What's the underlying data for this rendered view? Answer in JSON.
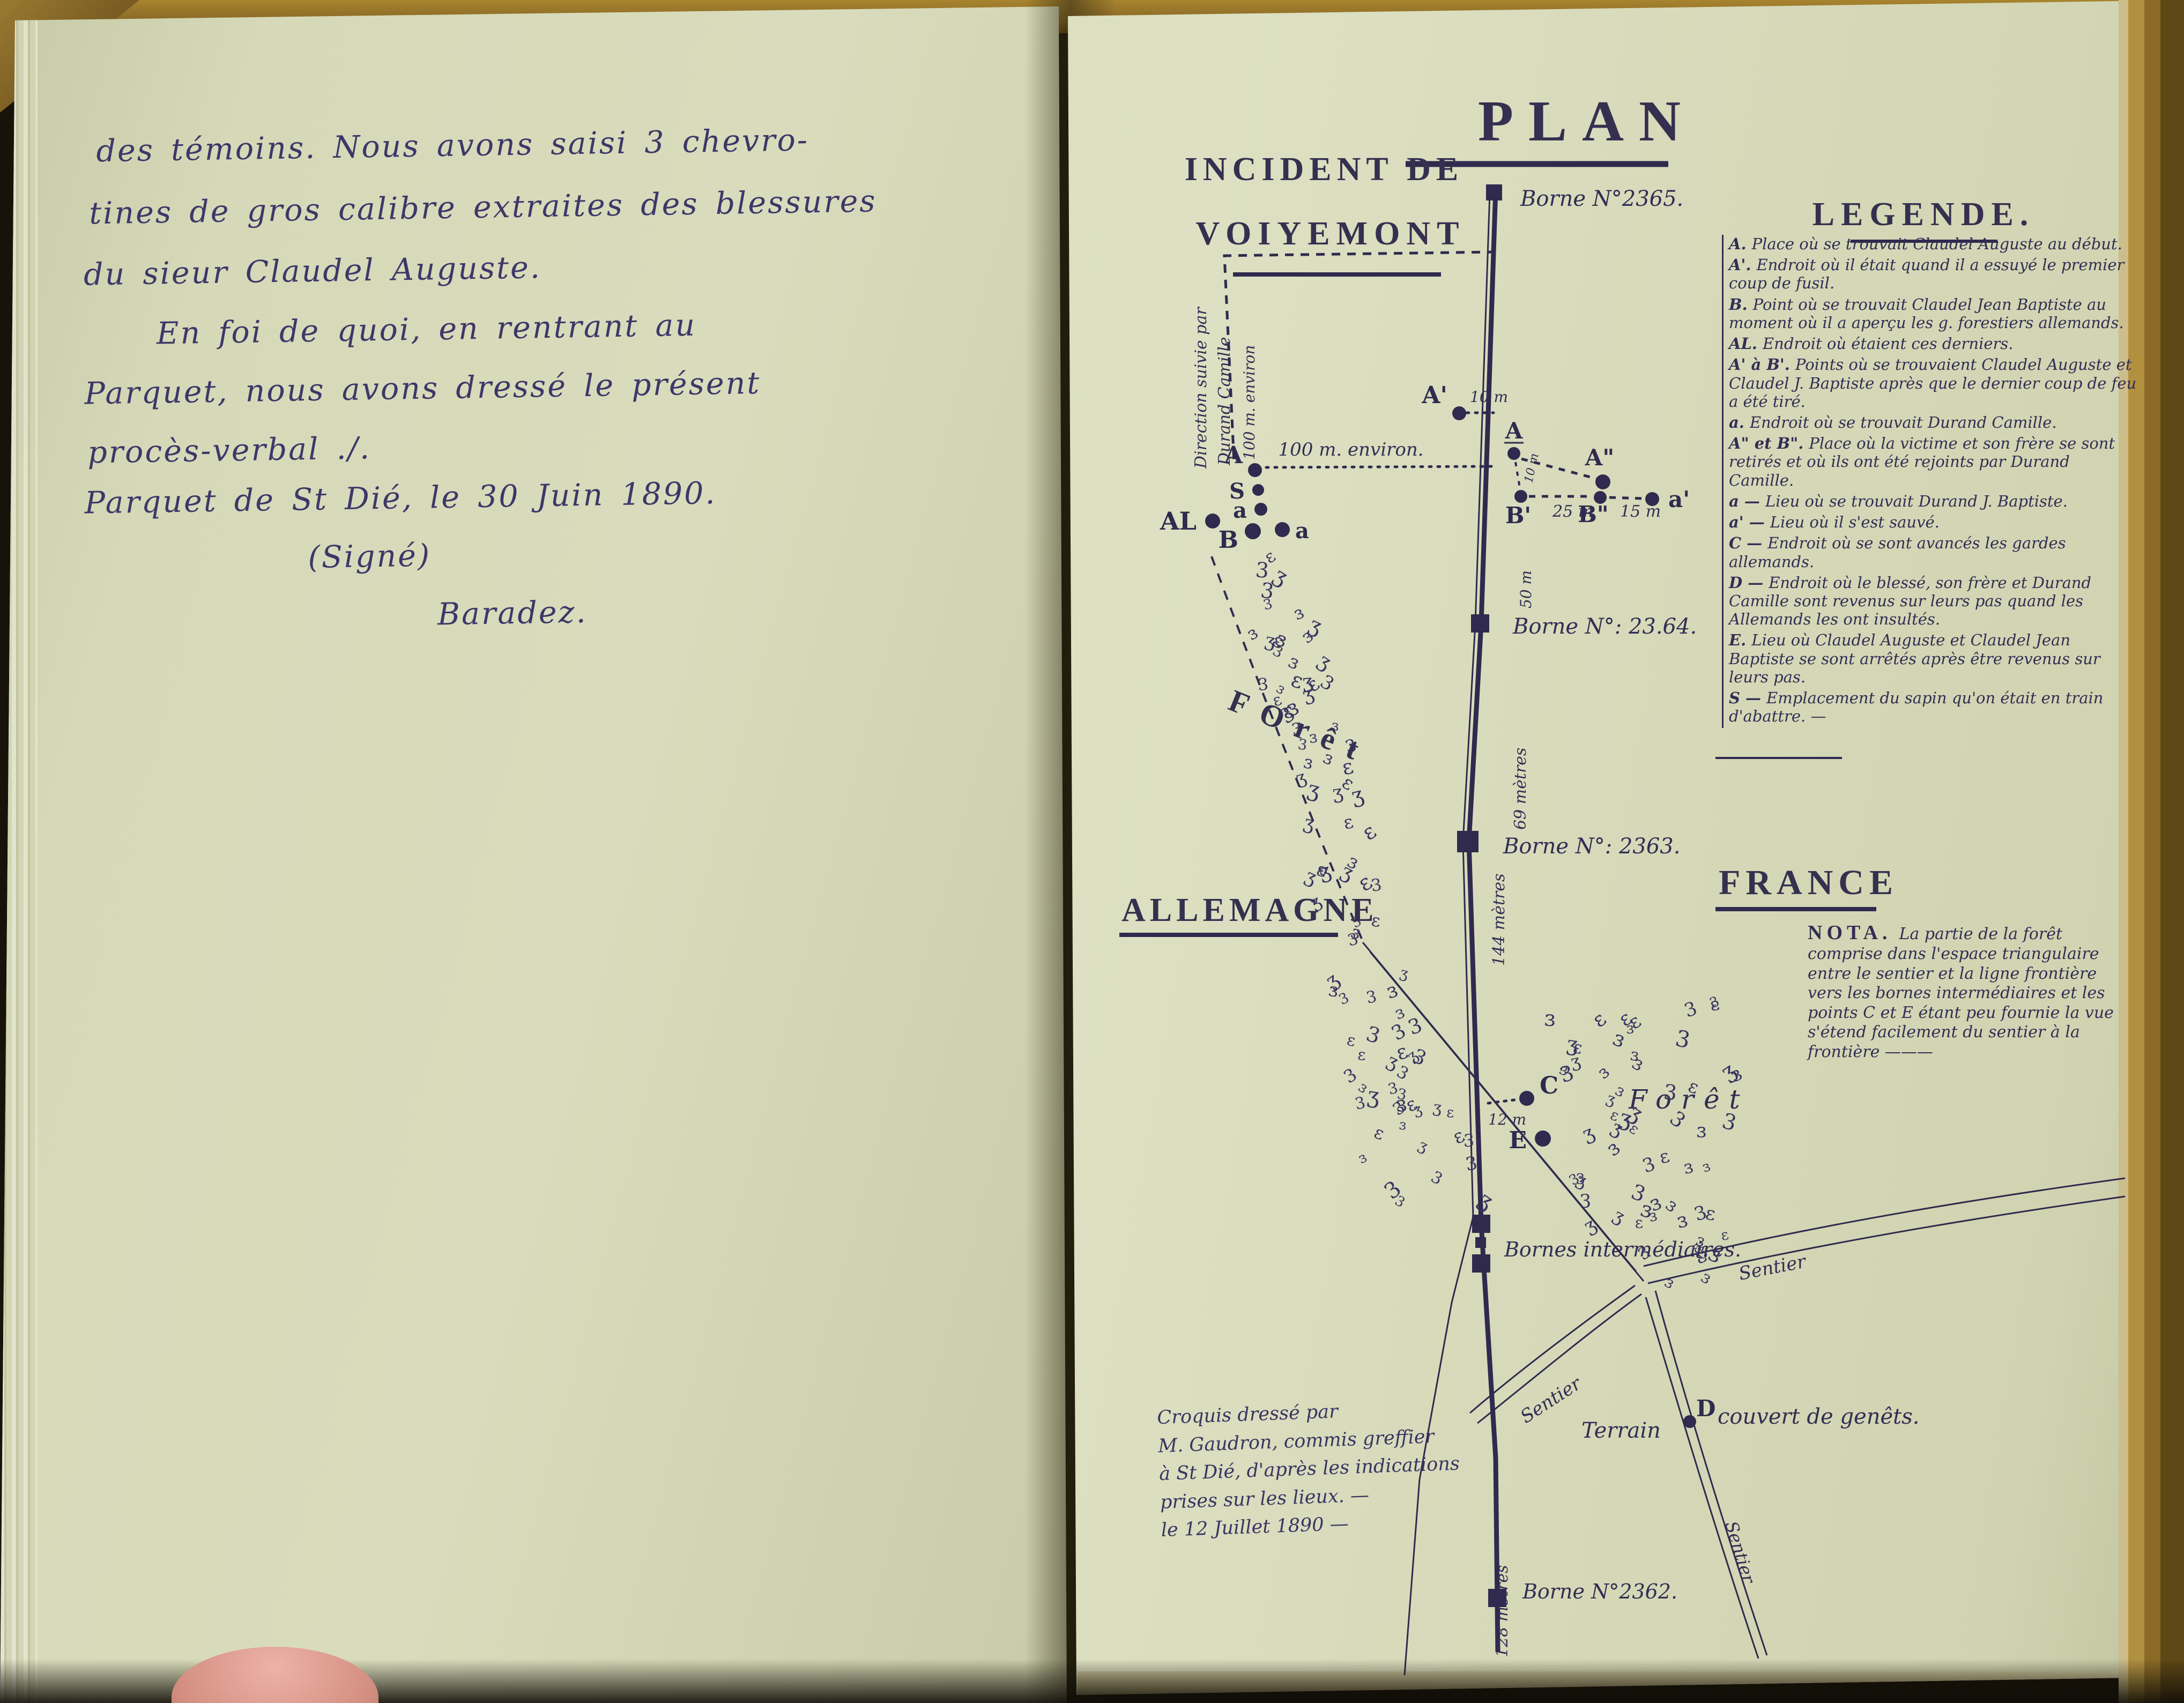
{
  "left_page": {
    "lines": [
      "des témoins. Nous avons saisi 3 chevro-",
      "tines de gros calibre extraites des blessures",
      "du sieur Claudel Auguste.",
      "En foi de quoi, en rentrant au",
      "Parquet, nous avons dressé le présent",
      "procès-verbal ./.",
      "Parquet de St Dié, le 30 Juin 1890.",
      "(Signé)",
      "Baradez."
    ]
  },
  "map": {
    "title": "PLAN",
    "subtitle": {
      "line1": "INCIDENT DE",
      "line2": "VOIYEMONT"
    },
    "legend": {
      "title": "LEGENDE.",
      "entries": [
        {
          "key": "A.",
          "text": "Place où se trouvait Claudel Auguste au début."
        },
        {
          "key": "A'.",
          "text": "Endroit où il était quand il a essuyé le premier coup de fusil."
        },
        {
          "key": "B.",
          "text": "Point où se trouvait Claudel Jean Baptiste au moment où il a aperçu les g. forestiers allemands."
        },
        {
          "key": "AL.",
          "text": "Endroit où étaient ces derniers."
        },
        {
          "key": "A' à B'.",
          "text": "Points où se trouvaient Claudel Auguste et Claudel J. Baptiste après que le dernier coup de feu a été tiré."
        },
        {
          "key": "a.",
          "text": "Endroit où se trouvait Durand Camille."
        },
        {
          "key": "A\" et B\".",
          "text": "Place où la victime et son frère se sont retirés et où ils ont été rejoints par Durand Camille."
        },
        {
          "key": "a —",
          "text": "Lieu où se trouvait Durand J. Baptiste."
        },
        {
          "key": "a' —",
          "text": "Lieu où il s'est sauvé."
        },
        {
          "key": "C —",
          "text": "Endroit où se sont avancés les gardes allemands."
        },
        {
          "key": "D —",
          "text": "Endroit où le blessé, son frère et Durand Camille sont revenus sur leurs pas quand les Allemands les ont insultés."
        },
        {
          "key": "E.",
          "text": "Lieu où Claudel Auguste et Claudel Jean Baptiste se sont arrêtés après être revenus sur leurs pas."
        },
        {
          "key": "S —",
          "text": "Emplacement du sapin qu'on était en train d'abattre. —"
        }
      ]
    },
    "regions": {
      "left": "ALLEMAGNE",
      "right": "FRANCE"
    },
    "nota": {
      "title": "NOTA.",
      "text": "La partie de la forêt comprise dans l'espace triangulaire entre le sentier et la ligne frontière vers les bornes intermédiaires et les points C et E étant peu fournie la vue s'étend facilement du sentier à la frontière ———"
    },
    "bornes": {
      "b2365": "Borne N°2365.",
      "b2364": "Borne N°: 23.64.",
      "b2363": "Borne N°: 2363.",
      "intermediaires": "Bornes intermédiaires.",
      "b2362": "Borne N°2362."
    },
    "distances": {
      "a_row": "100 m. environ.",
      "a_col": "100 m. environ",
      "ap10": "10 m",
      "ab10": "10 m",
      "bp25": "25 m",
      "bpp15": "15 m",
      "c12": "12 m",
      "seg50": "50 m",
      "seg69": "69 mètres",
      "seg144": "144 mètres",
      "seg128": "128 mètres"
    },
    "labels": {
      "direction1": "Direction suivie par",
      "direction2": "Durand Camille",
      "foret_stamp": "FOrêt",
      "foret_hand": "Forêt",
      "sentier_e": "Sentier",
      "sentier_w": "Sentier",
      "sentier_s": "Sentier",
      "terrain_l": "Terrain",
      "terrain_r": "couvert de genêts."
    },
    "points": {
      "A": "A",
      "Ap": "A'",
      "S": "S",
      "a": "a",
      "B": "B",
      "a2": "a",
      "AL": "AL",
      "A_road": "A",
      "Bp": "B'",
      "App": "A\"",
      "Bpp": "B\"",
      "ap": "a'",
      "C": "C",
      "E": "E",
      "D": "D"
    },
    "forest_glyphs": "3ɜεʒ",
    "credit": {
      "lines": [
        "Croquis dressé par",
        "M. Gaudron, commis greffier",
        "à St Dié, d'après les indications",
        "prises sur les lieux. —",
        "le 12 Juillet 1890 —"
      ]
    }
  }
}
